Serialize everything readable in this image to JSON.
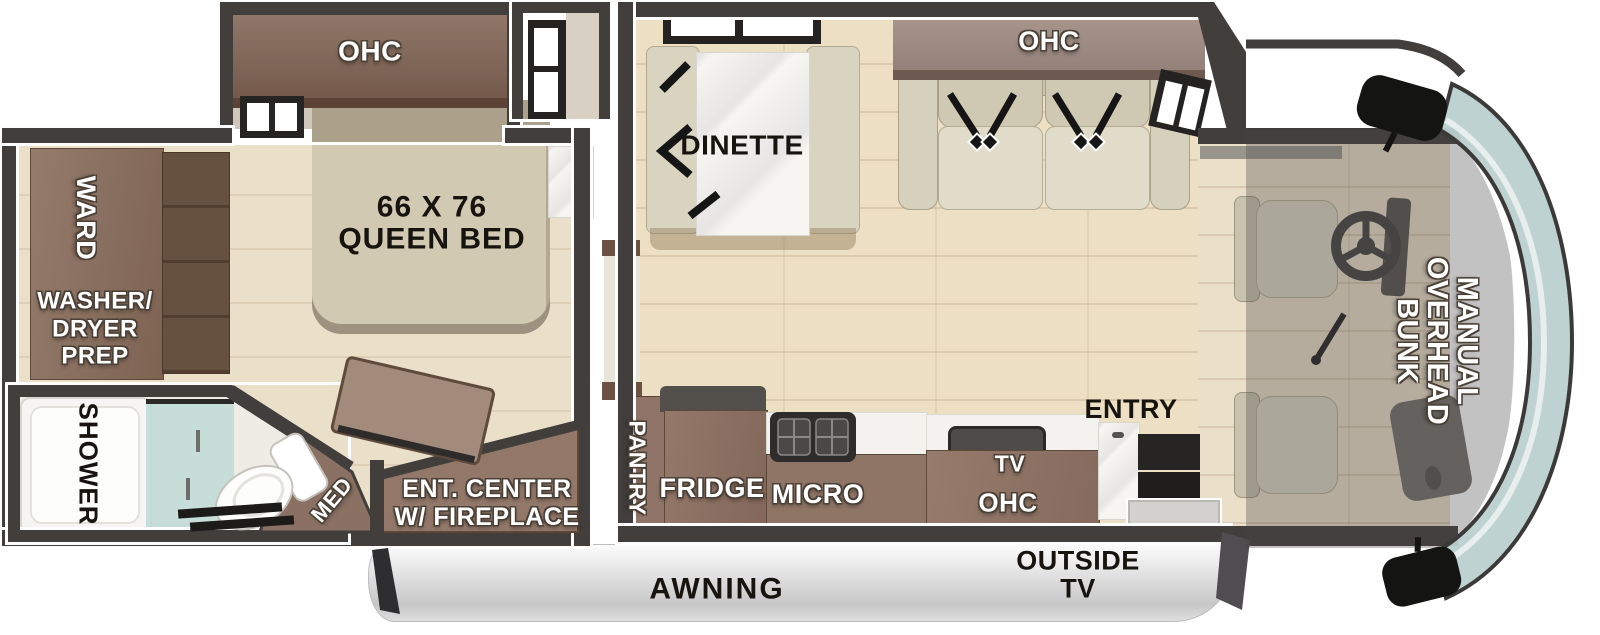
{
  "scene": {
    "type": "rv-motorhome-floorplan-top-view",
    "areas": [
      "bedroom-slideout",
      "bedroom",
      "bathroom",
      "kitchen-galley",
      "dinette-living",
      "cab",
      "awning-side"
    ]
  },
  "labels": {
    "bedroom_ohc": "OHC",
    "ward": "WARD",
    "washer_dryer": "WASHER/\nDRYER\nPREP",
    "queen_bed": "66 X 76\nQUEEN BED",
    "shower": "SHOWER",
    "med": "MED",
    "ent_center": "ENT. CENTER\nW/ FIREPLACE",
    "dinette": "DINETTE",
    "living_ohc": "OHC",
    "pantry": "PANTRY",
    "fridge": "FRIDGE",
    "micro": "MICRO",
    "tv": "TV",
    "kitchen_ohc": "OHC",
    "entry": "ENTRY",
    "overhead_bunk": "MANUAL\nOVERHEAD\nBUNK",
    "awning": "AWNING",
    "outside_tv": "OUTSIDE\nTV"
  },
  "colors": {
    "wall": "#413e3c",
    "wood_floor": "#ecdfc4",
    "bedroom_floor": "#eadfc9",
    "cabinet_brown": "#8d7365",
    "cabinet_dark": "#6b5345",
    "ohc_mauve": "#a3908a",
    "upholstery_cream": "#d9d4c0",
    "marble": "#f6f5f2",
    "windshield_glass": "#bdd0d0",
    "awning_gray": "#d6d6d6",
    "bunk_shade": "rgba(72,70,70,0.33)"
  }
}
